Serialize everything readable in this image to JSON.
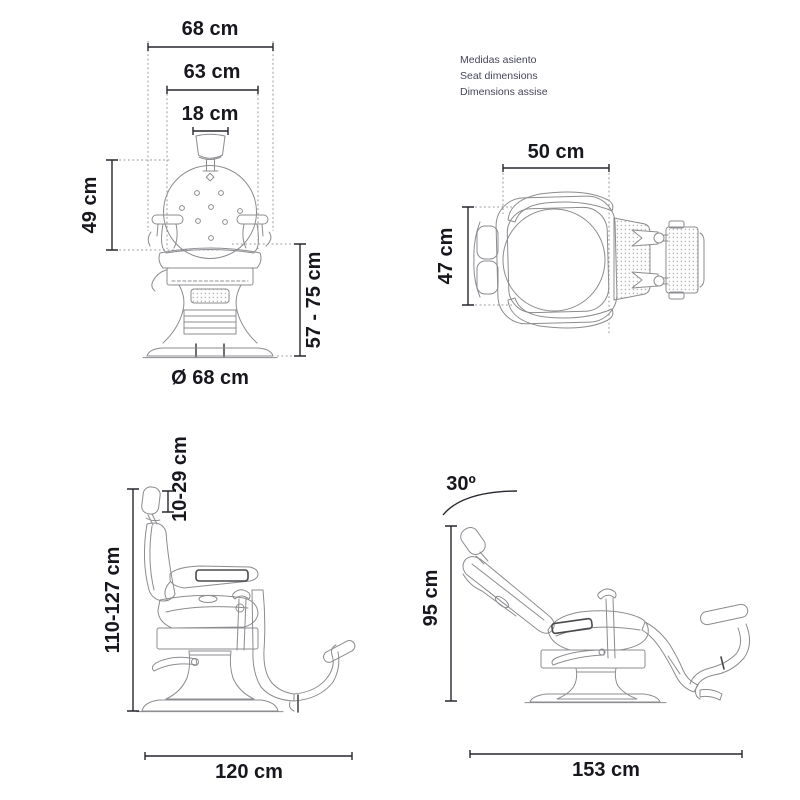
{
  "colors": {
    "background": "#ffffff",
    "drawing_line": "#8c8c90",
    "dimension_line": "#26262e",
    "extension_line": "#97979d",
    "label_text": "#17171e",
    "heading_text": "#45455a"
  },
  "views": {
    "front": {
      "labels": {
        "overall_width": "68 cm",
        "upper_width": "63 cm",
        "headrest_width": "18 cm",
        "backrest_height": "49 cm",
        "seat_height": "57 - 75 cm",
        "base_diameter": "Ø 68 cm"
      }
    },
    "top": {
      "heading": [
        "Medidas asiento",
        "Seat dimensions",
        "Dimensions assise"
      ],
      "labels": {
        "seat_width": "50 cm",
        "seat_depth": "47 cm"
      }
    },
    "side": {
      "labels": {
        "headrest_range": "10-29 cm",
        "total_height": "110-127 cm",
        "total_length": "120 cm"
      }
    },
    "reclined": {
      "labels": {
        "recline_angle": "30º",
        "height": "95 cm",
        "length": "153 cm"
      }
    }
  }
}
